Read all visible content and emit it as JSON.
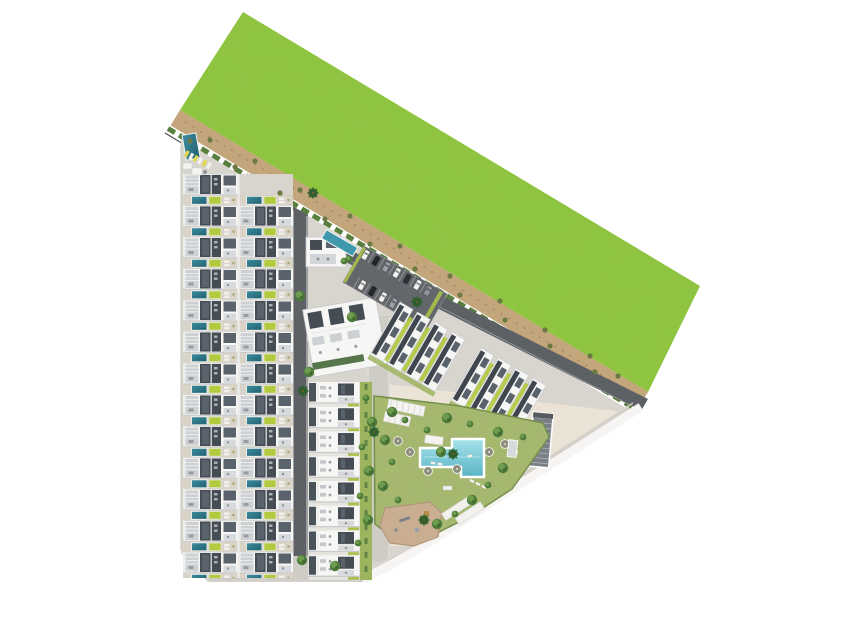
{
  "scene": {
    "kind": "aerial-site-plan-rendering",
    "description_elements": [
      "grass-field",
      "sand-path",
      "boundary-hedge",
      "rowhouse-block",
      "mid-apartment-column",
      "clubhouse",
      "clubhouse-pool",
      "parking-lot",
      "apartment-row-a",
      "apartment-row-b",
      "amenity-lawn",
      "community-pool",
      "playground",
      "pergolas",
      "carports",
      "ramp-structure",
      "trees",
      "palm-trees"
    ],
    "counts": {
      "rowhouse_rows": 13,
      "rowhouse_columns": 2,
      "mid_column_units": 8,
      "tilted_apartment_blocks": 8,
      "parking_cars": 12,
      "pool_umbrellas": 7,
      "palm_trees": 6
    },
    "amenities": [
      "communal-swimming-pool",
      "kids-playground",
      "sun-lawn",
      "private-plunge-pools",
      "pergolas",
      "parking"
    ]
  },
  "palette": {
    "field_green": "#8dc63f",
    "field_green_dark": "#6fa62c",
    "sand": "#c7a77b",
    "sand_dark": "#8f7350",
    "hedge_green": "#587f3d",
    "site_gray": "#d8d4ce",
    "cream": "#ebe4d6",
    "road_gray": "#cfccc5",
    "asphalt": "#5d6165",
    "building_white": "#f6f6f4",
    "roof_dark": "#454c54",
    "roof_mid": "#5a626b",
    "terrace_gray": "#cdd1d4",
    "garden_base": "#d9d3c8",
    "lime": "#b2ca3e",
    "pool_teal": "#2e7b8c",
    "pool_blue": "#6fc3d2",
    "lawn_green": "#a6ba6b",
    "tree_green": "#4c7a39",
    "tree_light": "#6d9c4e",
    "palm_green": "#2f5f2c",
    "playground_tan": "#c9ae92",
    "white_edge": "#f7f5f3",
    "fence": "#4c5156",
    "car_dark": "#22262b",
    "car_gray": "#9aa0a6",
    "umbrella_khaki": "#8f8f7e"
  }
}
